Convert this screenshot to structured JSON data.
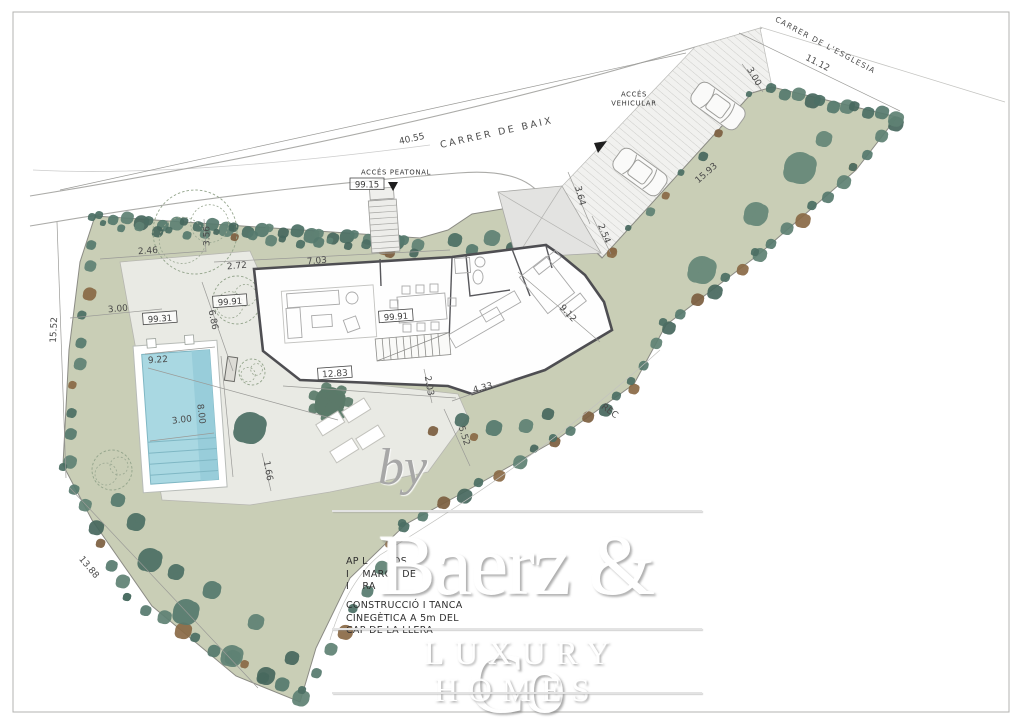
{
  "watermark": {
    "by": "by",
    "brand": "Baerz & Co",
    "tagline": "LUXURY HOMES"
  },
  "notes": [
    {
      "x": 346,
      "y": 556,
      "lines": [
        "AP L      LOS",
        "I    MARG   DE",
        "I    RA"
      ]
    },
    {
      "x": 346,
      "y": 600,
      "lines": [
        "CONSTRUCCIÓ I TANCA",
        "CINEGÈTICA A 5m DEL",
        "CAP DE LA LLERA"
      ]
    }
  ],
  "colors": {
    "field_green": "#c9ceb6",
    "tree_green": "#4c6f64",
    "pool_blue": "#a9d8e2",
    "terrace_grey": "#e9eae4",
    "wall_grey": "#4e4e52",
    "brown_shrub": "#7c5f40"
  },
  "labels": [
    {
      "text": "CARRER DE BAIX",
      "x": 497,
      "y": 134,
      "r": -12.5,
      "cls": "street"
    },
    {
      "text": "CARRER DE L'ESGLESIA",
      "x": 825,
      "y": 46,
      "r": 28,
      "cls": "street-sm"
    },
    {
      "text": "ACCÉS PEATONAL",
      "x": 396,
      "y": 173,
      "r": 0,
      "cls": "tiny"
    },
    {
      "text": "ACCÉS",
      "x": 634,
      "y": 95,
      "r": 0,
      "cls": "tiny"
    },
    {
      "text": "VEHICULAR",
      "x": 634,
      "y": 104,
      "r": 0,
      "cls": "tiny"
    },
    {
      "text": "REC",
      "x": 609,
      "y": 412,
      "r": 36,
      "cls": "dim"
    },
    {
      "text": "40.55",
      "x": 412,
      "y": 140,
      "r": -12.5,
      "cls": "dim"
    },
    {
      "text": "15.52",
      "x": 55,
      "y": 330,
      "r": -87,
      "cls": "dim"
    },
    {
      "text": "13.88",
      "x": 88,
      "y": 568,
      "r": 50,
      "cls": "dim"
    },
    {
      "text": "3.56",
      "x": 208,
      "y": 236,
      "r": -90,
      "cls": "dim"
    },
    {
      "text": "2.46",
      "x": 148,
      "y": 252,
      "r": -4,
      "cls": "dim"
    },
    {
      "text": "2.72",
      "x": 237,
      "y": 267,
      "r": -5,
      "cls": "dim"
    },
    {
      "text": "7.03",
      "x": 317,
      "y": 262,
      "r": -5,
      "cls": "dim"
    },
    {
      "text": "6.86",
      "x": 212,
      "y": 320,
      "r": 78,
      "cls": "dim"
    },
    {
      "text": "3.00",
      "x": 118,
      "y": 310,
      "r": -5,
      "cls": "dim"
    },
    {
      "text": "9.22",
      "x": 158,
      "y": 361,
      "r": -4,
      "cls": "dim"
    },
    {
      "text": "8.00",
      "x": 200,
      "y": 414,
      "r": 83,
      "cls": "dim"
    },
    {
      "text": "3.00",
      "x": 182,
      "y": 421,
      "r": -7,
      "cls": "dim"
    },
    {
      "text": "2.03",
      "x": 428,
      "y": 386,
      "r": 80,
      "cls": "dim"
    },
    {
      "text": "4.33",
      "x": 483,
      "y": 389,
      "r": -15,
      "cls": "dim"
    },
    {
      "text": "5.52",
      "x": 463,
      "y": 436,
      "r": 72,
      "cls": "dim"
    },
    {
      "text": "1.66",
      "x": 267,
      "y": 471,
      "r": 80,
      "cls": "dim"
    },
    {
      "text": "9.12",
      "x": 567,
      "y": 314,
      "r": 47,
      "cls": "dim"
    },
    {
      "text": "15.93",
      "x": 707,
      "y": 174,
      "r": -41,
      "cls": "dim"
    },
    {
      "text": "3.64",
      "x": 579,
      "y": 196,
      "r": 75,
      "cls": "dim"
    },
    {
      "text": "2.54",
      "x": 603,
      "y": 234,
      "r": 68,
      "cls": "dim"
    },
    {
      "text": "3.00",
      "x": 753,
      "y": 77,
      "r": 60,
      "cls": "dim"
    },
    {
      "text": "11.12",
      "x": 817,
      "y": 64,
      "r": 27,
      "cls": "dim"
    },
    {
      "text": "12.83",
      "x": 335,
      "y": 375,
      "r": -4,
      "cls": "dim",
      "boxed": true
    },
    {
      "text": "99.15",
      "x": 367,
      "y": 186,
      "r": 0,
      "cls": "elev",
      "boxed": true
    },
    {
      "text": "99.31",
      "x": 160,
      "y": 320,
      "r": -4,
      "cls": "elev",
      "boxed": true
    },
    {
      "text": "99.91",
      "x": 230,
      "y": 303,
      "r": -4,
      "cls": "elev",
      "boxed": true
    },
    {
      "text": "99.91",
      "x": 396,
      "y": 318,
      "r": -4,
      "cls": "elev",
      "boxed": true
    }
  ]
}
